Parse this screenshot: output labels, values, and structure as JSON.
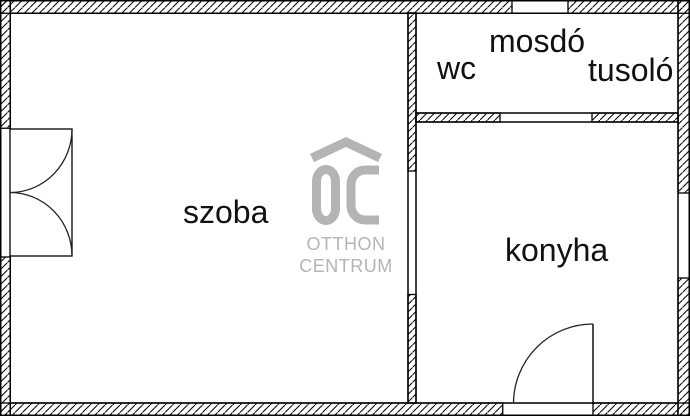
{
  "rooms": {
    "szoba": "szoba",
    "konyha": "konyha",
    "wc": "wc",
    "mosdo": "mosdó",
    "tusolo": "tusoló"
  },
  "logo": {
    "monogram": "OC",
    "brand_line1": "OTTHON",
    "brand_line2": "CENTRUM",
    "color": "#b4b4b4"
  },
  "colors": {
    "background": "#ffffff",
    "walls": "#000000"
  }
}
